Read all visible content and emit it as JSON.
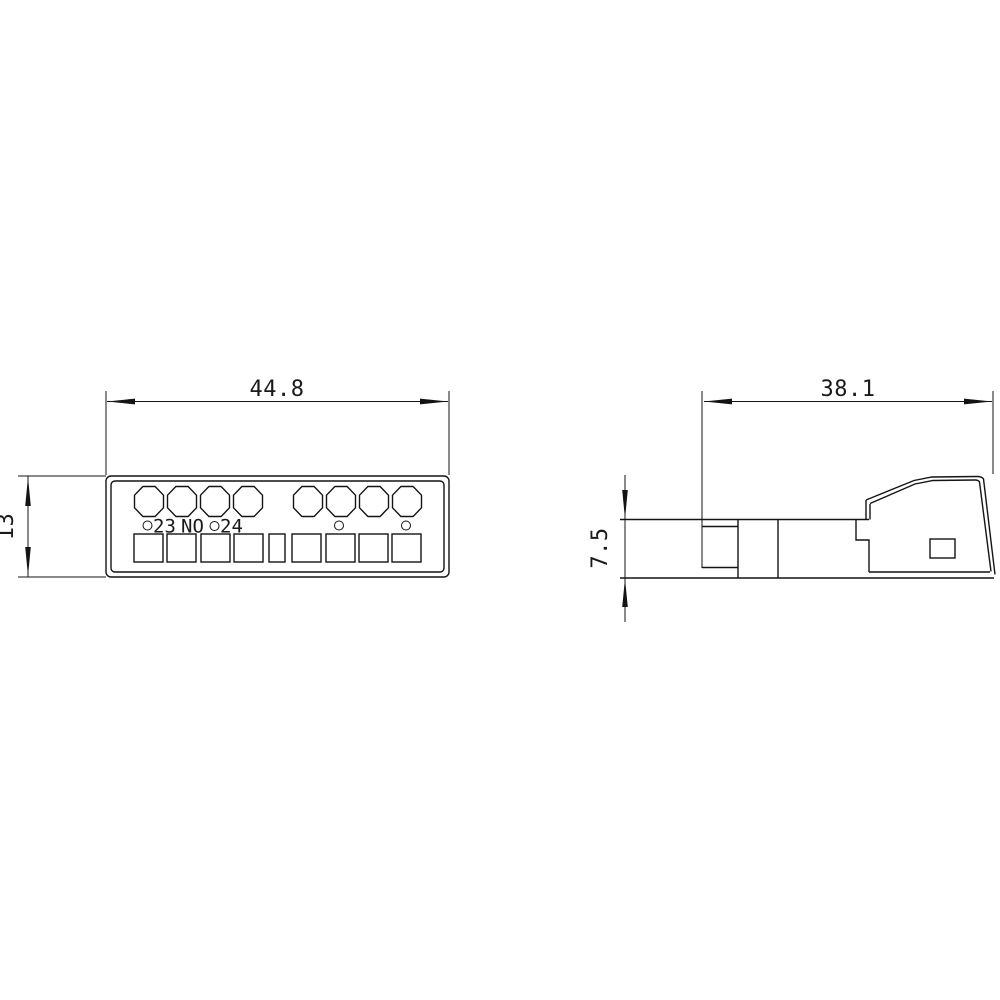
{
  "canvas": {
    "background": "#ffffff",
    "ink": "#141414"
  },
  "front_view": {
    "description": "front view of terminal block with screw heads and clamp openings",
    "width_dim": "44.8",
    "height_dim": "13",
    "terminals": {
      "left": "23",
      "type": "NO",
      "right": "24"
    }
  },
  "side_view": {
    "description": "side profile view with snap-on clip wedge",
    "width_dim": "38.1",
    "height_dim": "7.5"
  }
}
